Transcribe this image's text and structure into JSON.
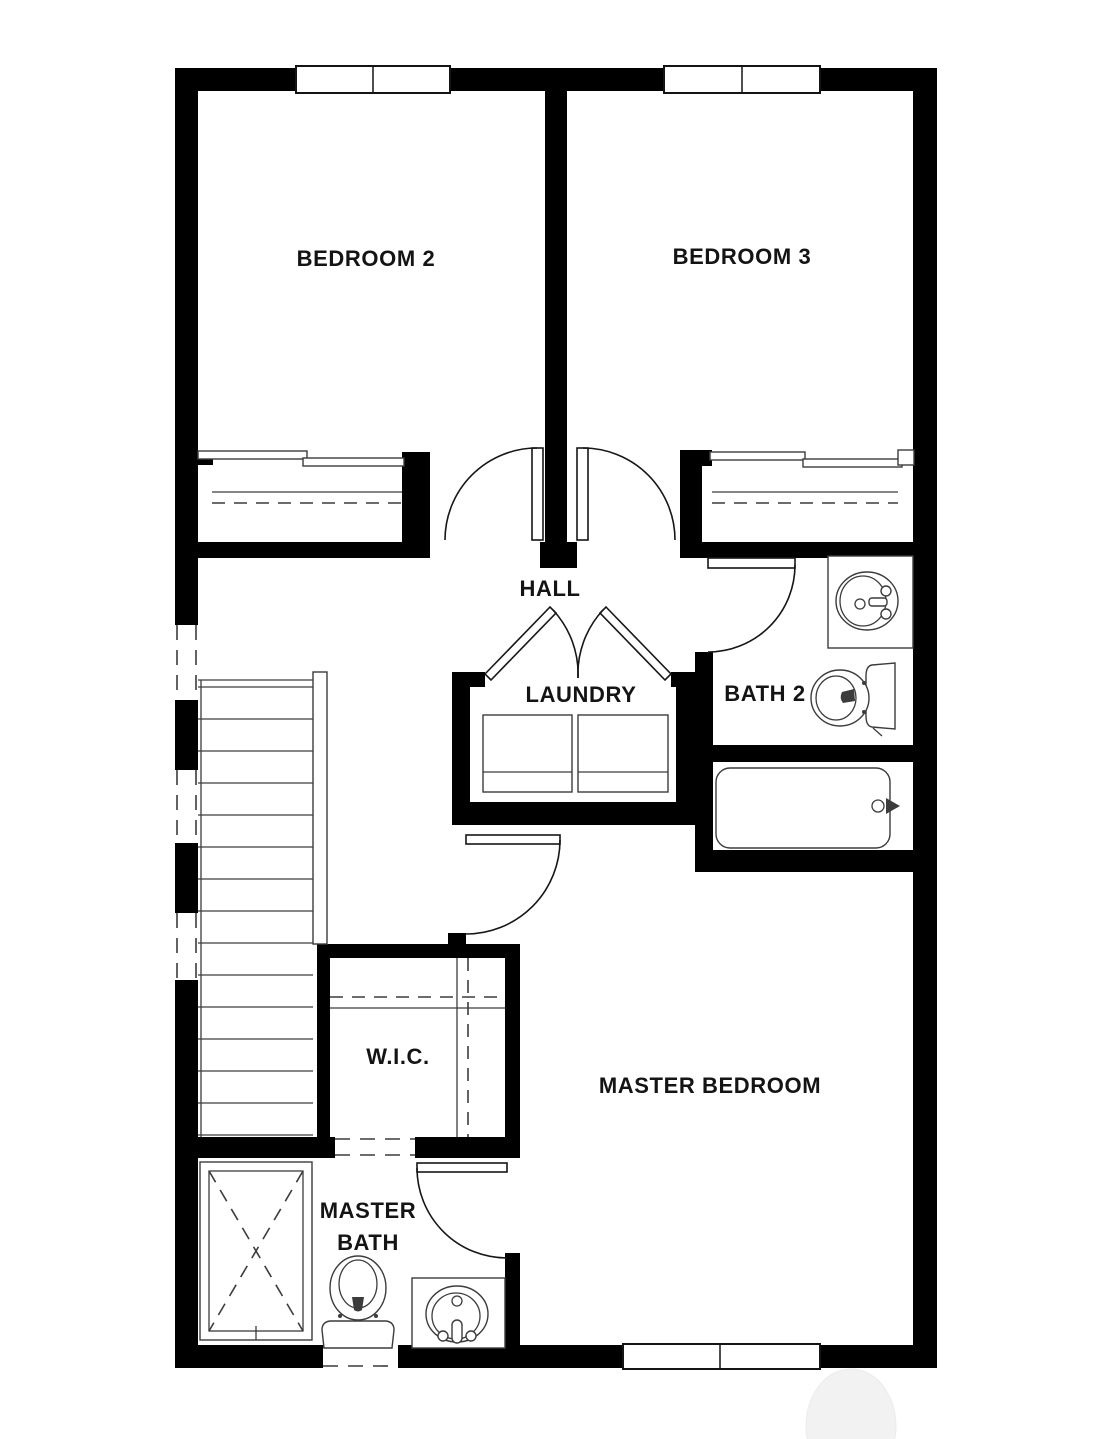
{
  "labels": {
    "bedroom2": "BEDROOM 2",
    "bedroom3": "BEDROOM 3",
    "hall": "HALL",
    "laundry": "LAUNDRY",
    "bath2": "BATH 2",
    "wic": "W.I.C.",
    "master_bedroom": "MASTER BEDROOM",
    "master_bath_line1": "MASTER",
    "master_bath_line2": "BATH"
  },
  "colors": {
    "wall": "#000000",
    "fixture_line": "#3c3c3c",
    "label_text": "#141414",
    "background": "#ffffff",
    "watermark": "#f2f2f2"
  },
  "fixtures": {
    "bath2": [
      "sink-vanity",
      "toilet",
      "bathtub"
    ],
    "master_bath": [
      "shower",
      "toilet",
      "sink-vanity"
    ],
    "laundry": [
      "washer",
      "dryer"
    ],
    "circulation": [
      "staircase",
      "handrail"
    ],
    "closets": [
      "bedroom2-sliding-closet",
      "bedroom3-sliding-closet",
      "walk-in-closet"
    ]
  },
  "windows": [
    "bedroom2-window",
    "bedroom3-window",
    "master-bedroom-window"
  ]
}
